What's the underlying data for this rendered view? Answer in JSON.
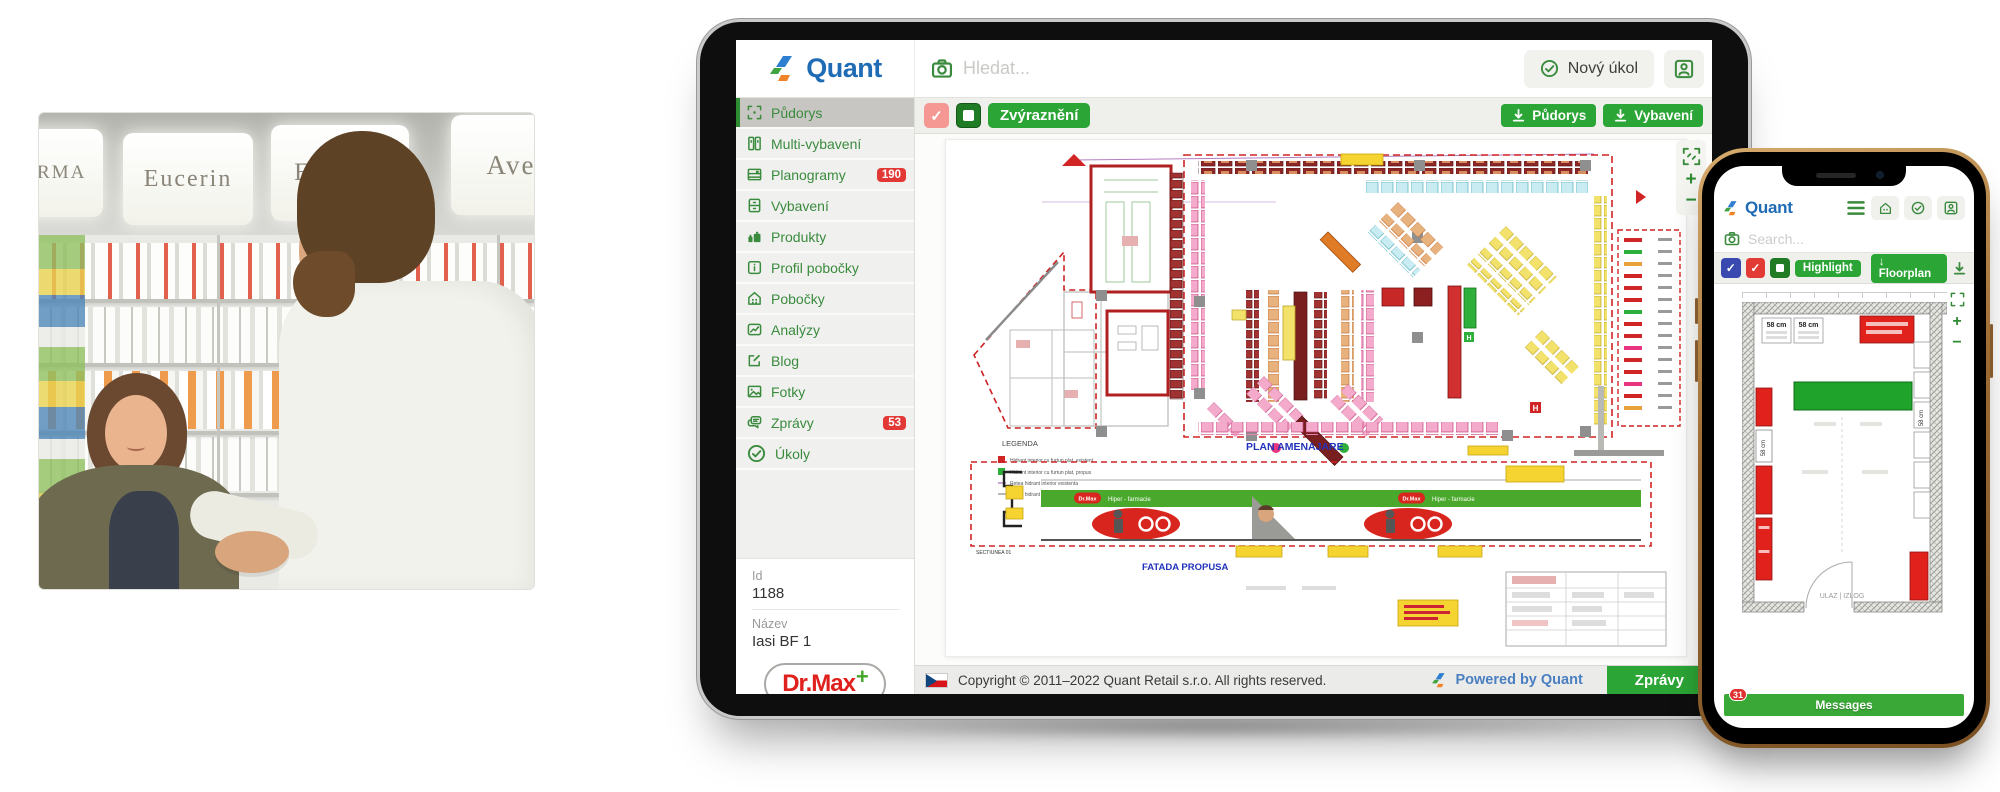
{
  "photo": {
    "signs": [
      "DERMA",
      "Eucerin",
      "Eucerin",
      "Ave"
    ]
  },
  "tablet": {
    "logo_text": "Quant",
    "search_placeholder": "Hledat...",
    "new_task_label": "Nový úkol",
    "toolbar": {
      "highlight_label": "Zvýraznění",
      "download_floorplan_label": "Půdorys",
      "download_equipment_label": "Vybavení",
      "zoom_in": "+",
      "zoom_out": "−"
    },
    "sidebar": {
      "items": [
        {
          "icon": "floorplan",
          "label": "Půdorys"
        },
        {
          "icon": "grid",
          "label": "Multi-vybavení"
        },
        {
          "icon": "planogram",
          "label": "Planogramy",
          "badge": "190"
        },
        {
          "icon": "cabinet",
          "label": "Vybavení"
        },
        {
          "icon": "products",
          "label": "Produkty"
        },
        {
          "icon": "info",
          "label": "Profil pobočky"
        },
        {
          "icon": "store",
          "label": "Pobočky"
        },
        {
          "icon": "chart",
          "label": "Analýzy"
        },
        {
          "icon": "edit",
          "label": "Blog"
        },
        {
          "icon": "photo",
          "label": "Fotky"
        },
        {
          "icon": "chat",
          "label": "Zprávy",
          "badge": "53"
        },
        {
          "icon": "check",
          "label": "Úkoly"
        }
      ]
    },
    "details": {
      "id_label": "Id",
      "id_value": "1188",
      "name_label": "Název",
      "name_value": "Iasi BF 1"
    },
    "brand": {
      "name": "Dr.Max",
      "plus": "+"
    },
    "plan": {
      "title": "PLAN AMENAJARE",
      "legend_title": "LEGENDA",
      "legend_items": [
        "Hidrant interior cu furtun plat, existent",
        "Hidrant interior cu furtun plat, propus",
        "Retea hidrant interior existenta",
        "Retea hidrant interior propusa"
      ],
      "facade_title": "FATADA PROPUSA",
      "section_label": "SECTIUNEA 01",
      "banner_brand": "Dr.Max",
      "banner_text": "Hiper - farmacie"
    },
    "footer": {
      "copyright": "Copyright © 2011–2022 Quant Retail s.r.o. All rights reserved.",
      "powered_by": "Powered by Quant",
      "messages_button": "Zprávy"
    }
  },
  "phone": {
    "logo_text": "Quant",
    "search_placeholder": "Search...",
    "toolbar": {
      "highlight_label": "Highlight",
      "download_floorplan_label": "Floorplan",
      "zoom_in": "+",
      "zoom_out": "−"
    },
    "plan": {
      "dim_a": "58 cm",
      "dim_b": "58 cm",
      "side_dim": "58 cm",
      "entrance_label": "ULAZ | IZLOG"
    },
    "messages_label": "Messages",
    "messages_badge": "31"
  },
  "colors": {
    "quant_green": "#2ba535",
    "quant_blue": "#1f6cb5",
    "badge_red": "#e23936",
    "brand_red": "#e0201c"
  }
}
